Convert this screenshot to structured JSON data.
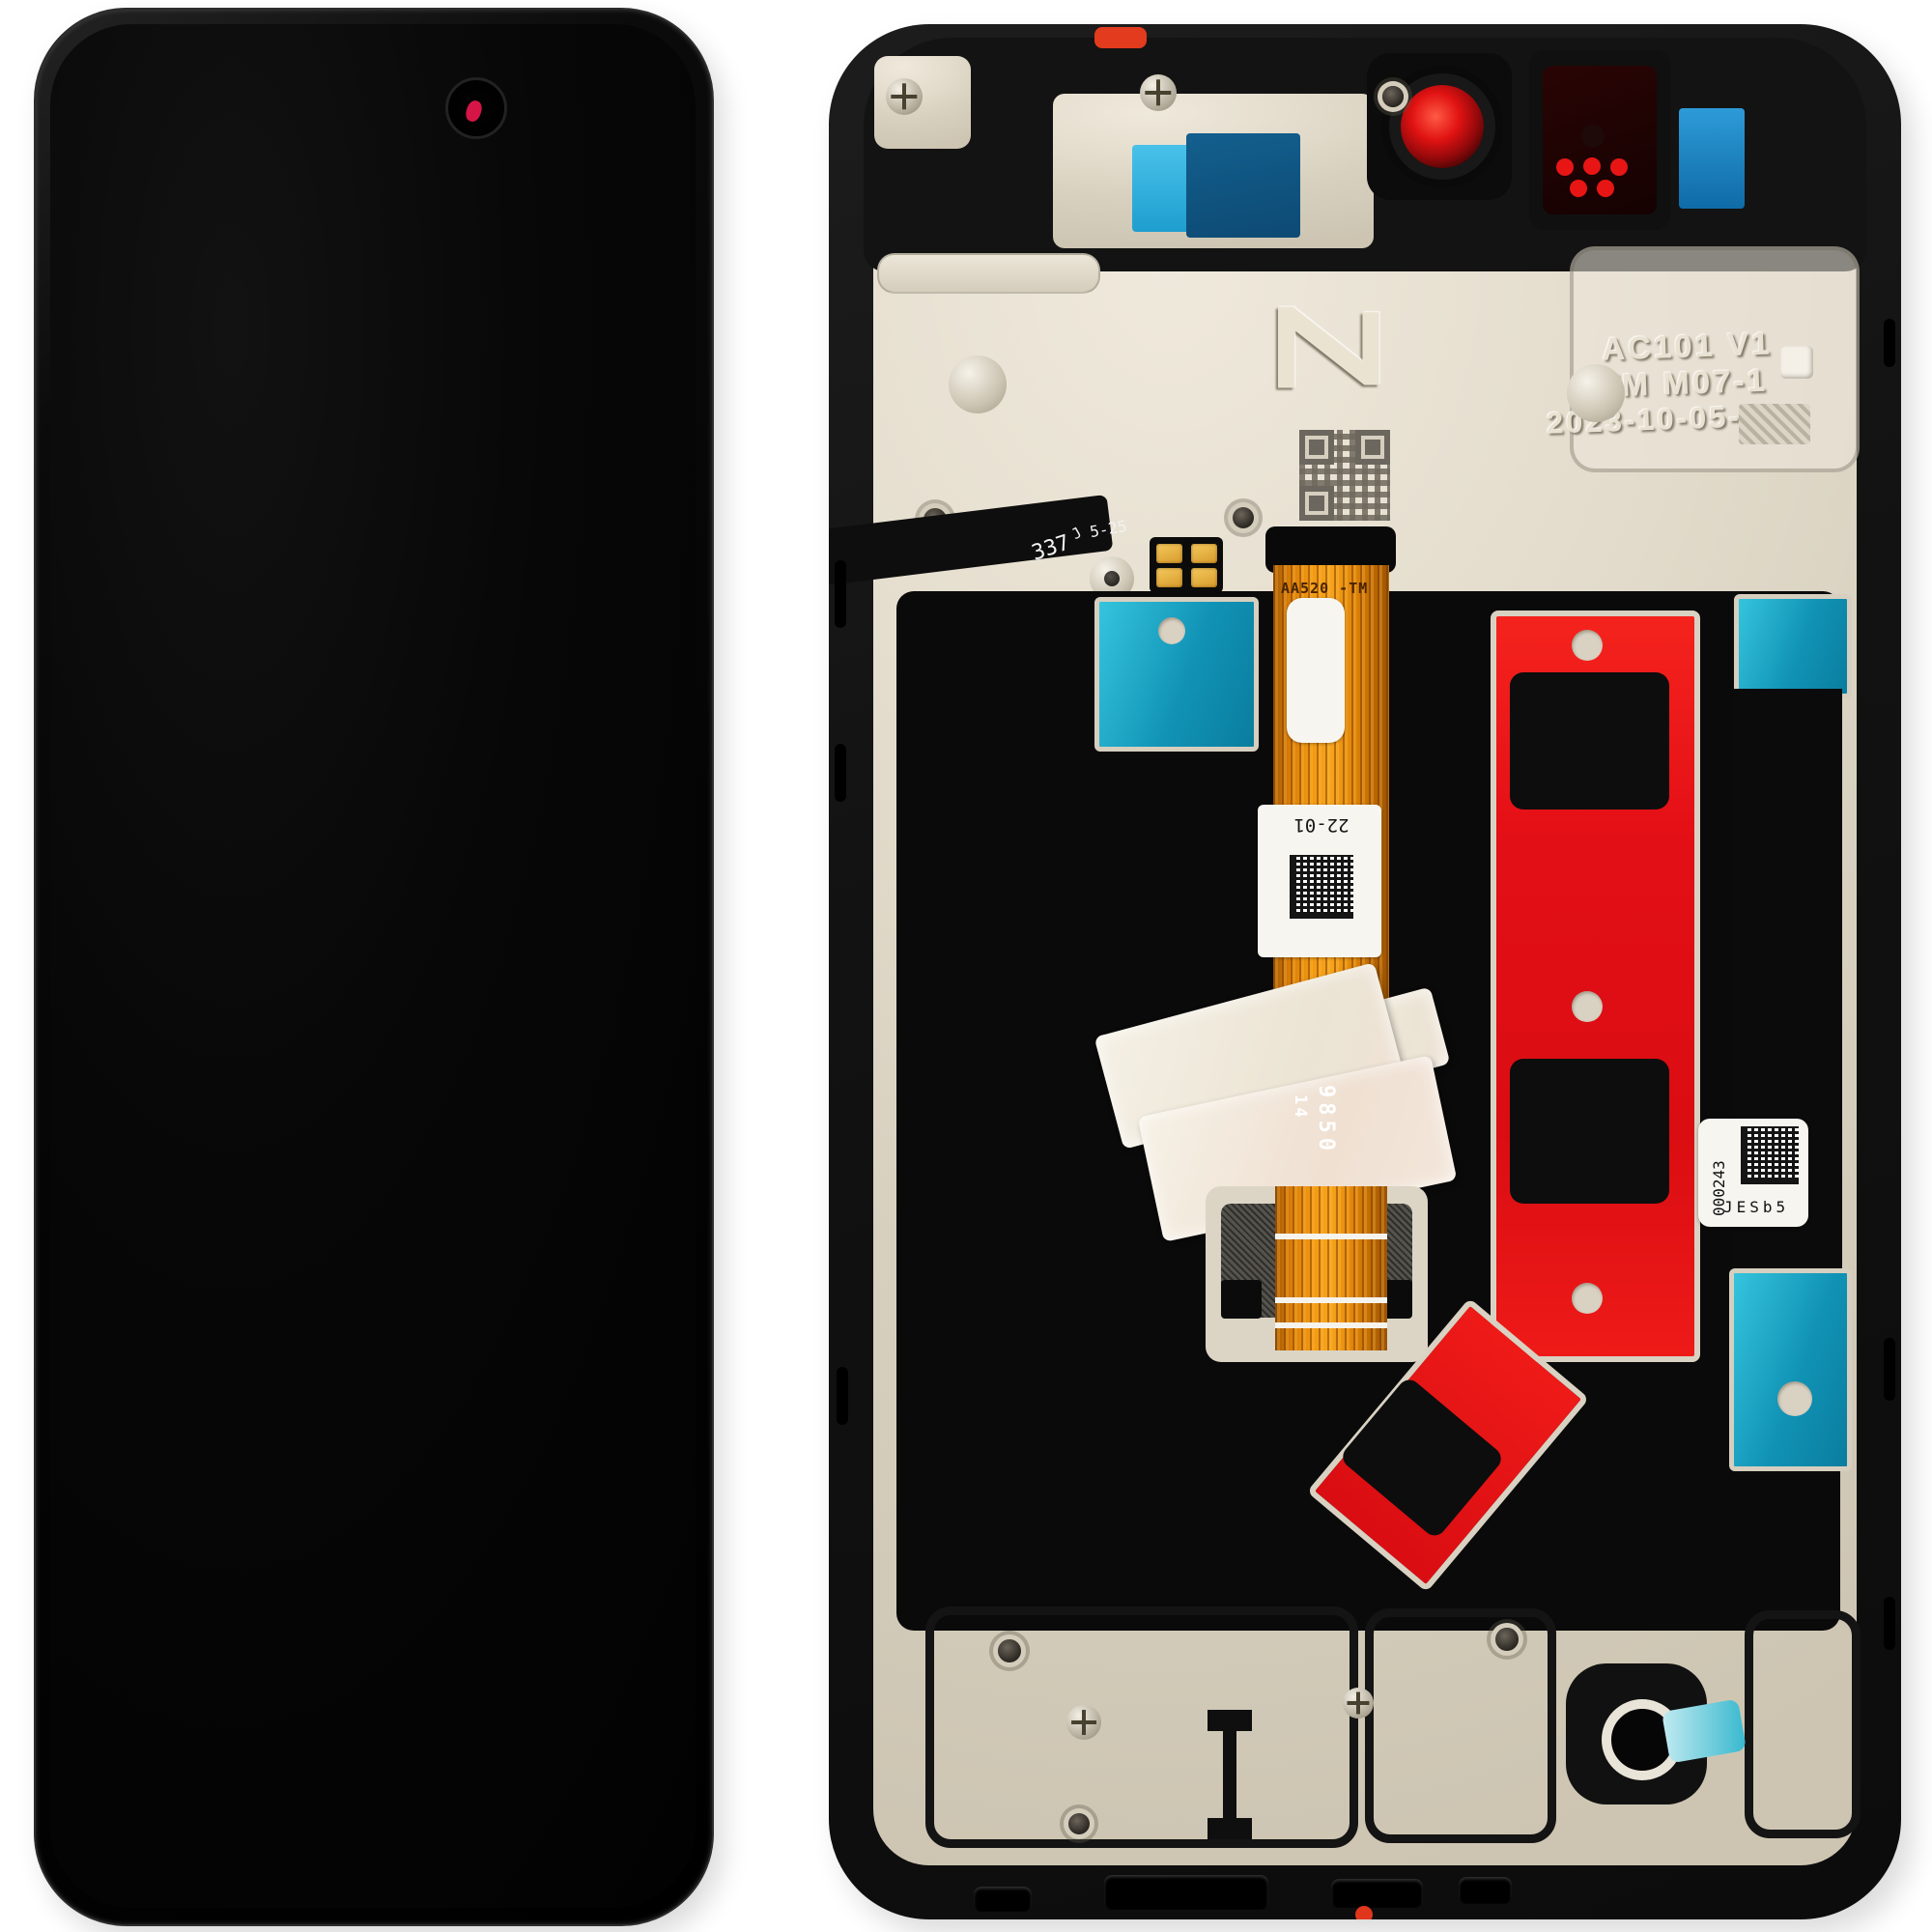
{
  "back": {
    "marks": {
      "logo": "Z",
      "etch1": "AC101 V1",
      "etch2": "TM M07-1",
      "etch3": "2023-10-05-9L",
      "flex_part": "AA520 -TM",
      "flex_label": "22-01",
      "num_big": "9850",
      "num_small": "14",
      "side1": "337",
      "side2": "J",
      "side3": "5-25",
      "serial_num": "000243",
      "serial_code": "JESb5"
    },
    "colors": {
      "adhesive_red": "#e30f16",
      "adhesive_cyan": "#13a6c6",
      "adhesive_blue": "#1e86c0",
      "flex_orange": "#e88f0e",
      "metal": "#d9d2c2",
      "frame": "#141414",
      "camera_glint": "#e0164a"
    }
  }
}
